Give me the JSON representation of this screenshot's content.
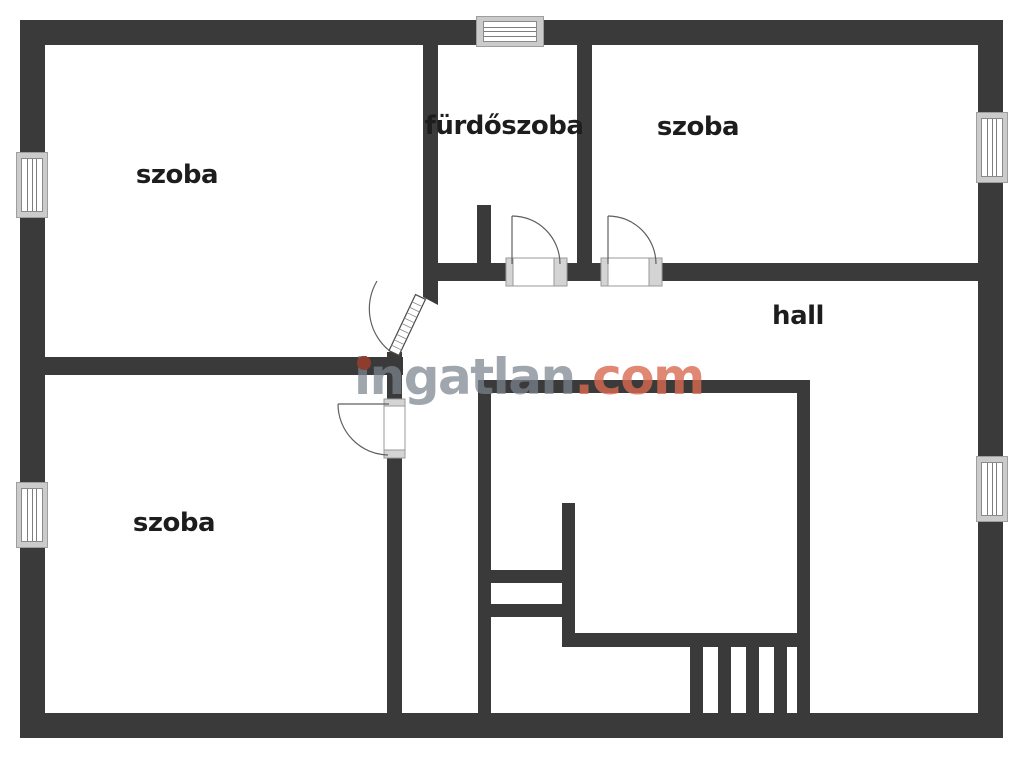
{
  "plan": {
    "type": "floor-plan",
    "rooms": {
      "top_left": {
        "label": "szoba"
      },
      "bathroom": {
        "label": "fürdőszoba"
      },
      "top_right": {
        "label": "szoba"
      },
      "hall": {
        "label": "hall"
      },
      "bottom_left": {
        "label": "szoba"
      }
    }
  },
  "watermark": {
    "brand": "ingatlan",
    "tld": ".com"
  },
  "colors": {
    "wall": "#3a3a3a",
    "label_text": "#1d1d1d",
    "window_frame": "#cbcbcb",
    "watermark_gray": "#7c838d",
    "watermark_accent": "#d86a50",
    "watermark_dot": "#8d3c2d"
  }
}
